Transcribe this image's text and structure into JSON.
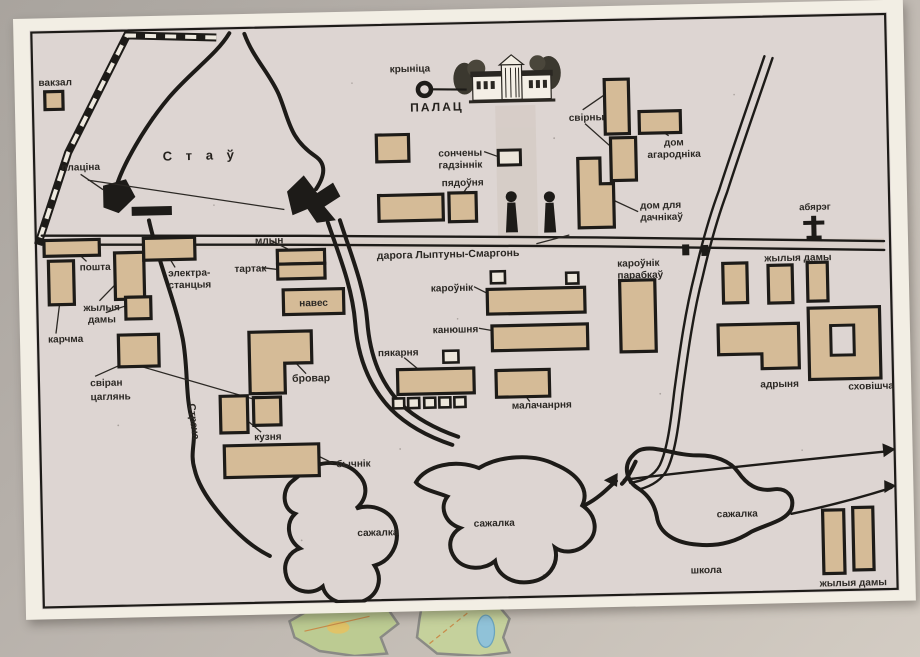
{
  "colors": {
    "map_background": "#ddd5d2",
    "frame": "#f2eee4",
    "building_fill": "#d5bb97",
    "line_ink": "#1d1b18",
    "road_band": "#d7ccc2",
    "fragment_green": "#bccb92",
    "fragment_lake": "#90c2d8"
  },
  "map": {
    "labels": {
      "vakzal": "вакзал",
      "placina": "плаціна",
      "stau": "С т а ў",
      "krynica": "крыніца",
      "palac": "ПАЛАЦ",
      "sunclock_l1": "сончены",
      "sunclock_l2": "гадзіннік",
      "piadounia": "пядоўня",
      "svirny": "свірны",
      "dom_agarodnika_l1": "дом",
      "dom_agarodnika_l2": "агародніка",
      "dom_dachnikau_l1": "дом для",
      "dom_dachnikau_l2": "дачнікаў",
      "abiareh": "абярэг",
      "poshta": "пошта",
      "elektra_l1": "электра-",
      "elektra_l2": "станцыя",
      "zhylyja_left_l1": "жылыя",
      "zhylyja_left_l2": "дамы",
      "karchma": "карчма",
      "sviran_l1": "свіран",
      "sviran_l2": "цаглянь",
      "mlyn": "млын",
      "tartak": "тартак",
      "naves": "навес",
      "daroha": "дарога Лыптуны-Смаргонь",
      "karounik": "кароўнік",
      "kaniushnia": "канюшня",
      "piakarnia": "пякарня",
      "malacharnia": "малачанрня",
      "brovar": "бровар",
      "kuznia": "кузня",
      "bychnik": "бычнік",
      "stracha": "Страча",
      "sazhalka_left": "сажалка",
      "sazhalka_mid": "сажалка",
      "sazhalka_right": "сажалка",
      "karounik_parabkau_l1": "кароўнік",
      "karounik_parabkau_l2": "парабкаў",
      "zhylyja_right": "жылыя дамы",
      "adrynia": "адрыня",
      "skhovishcha": "сховішча",
      "shkola": "школа",
      "zhylyja_bottom": "жылыя дамы"
    }
  }
}
